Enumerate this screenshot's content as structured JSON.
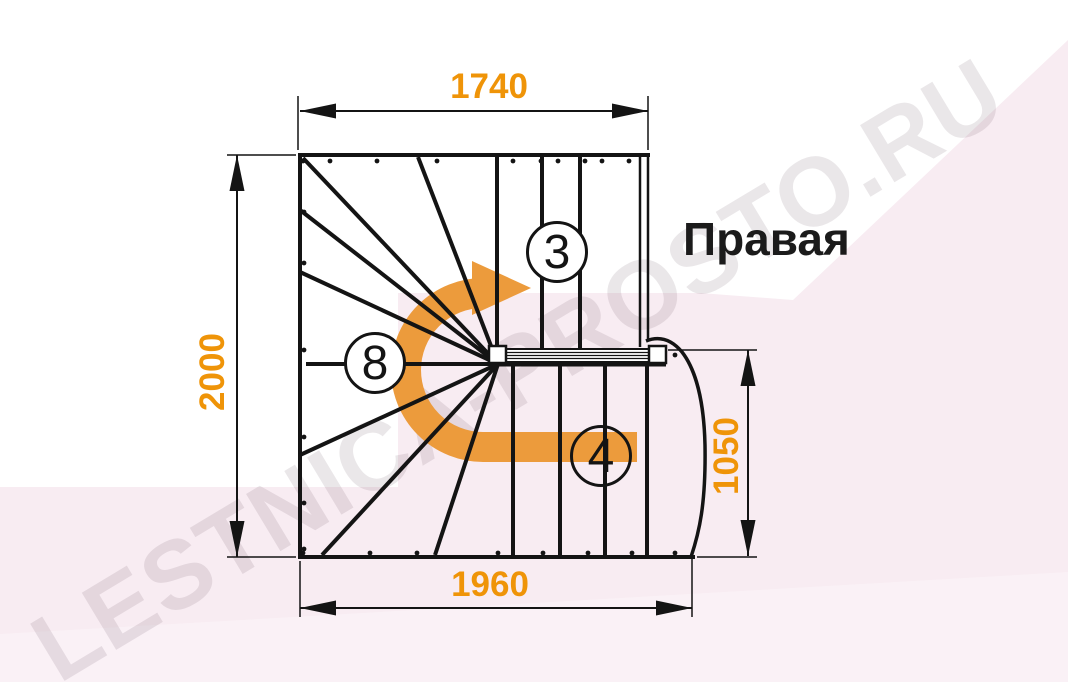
{
  "diagram": {
    "title": "Правая",
    "watermark": "LESTNICA-PROSTO.RU",
    "dimensions_mm": {
      "top_width": "1740",
      "left_depth": "2000",
      "bottom_width": "1960",
      "right_entry_width": "1050"
    },
    "step_counts": {
      "upper_flight": "3",
      "winder_steps": "8",
      "lower_flight": "4"
    },
    "colors": {
      "dimension_text": "#EF9408",
      "direction_arrow": "#EC9B3C",
      "linework": "#141414",
      "background_tint": "#F8ECF2",
      "watermark_text": "rgba(95,70,85,0.13)"
    }
  }
}
